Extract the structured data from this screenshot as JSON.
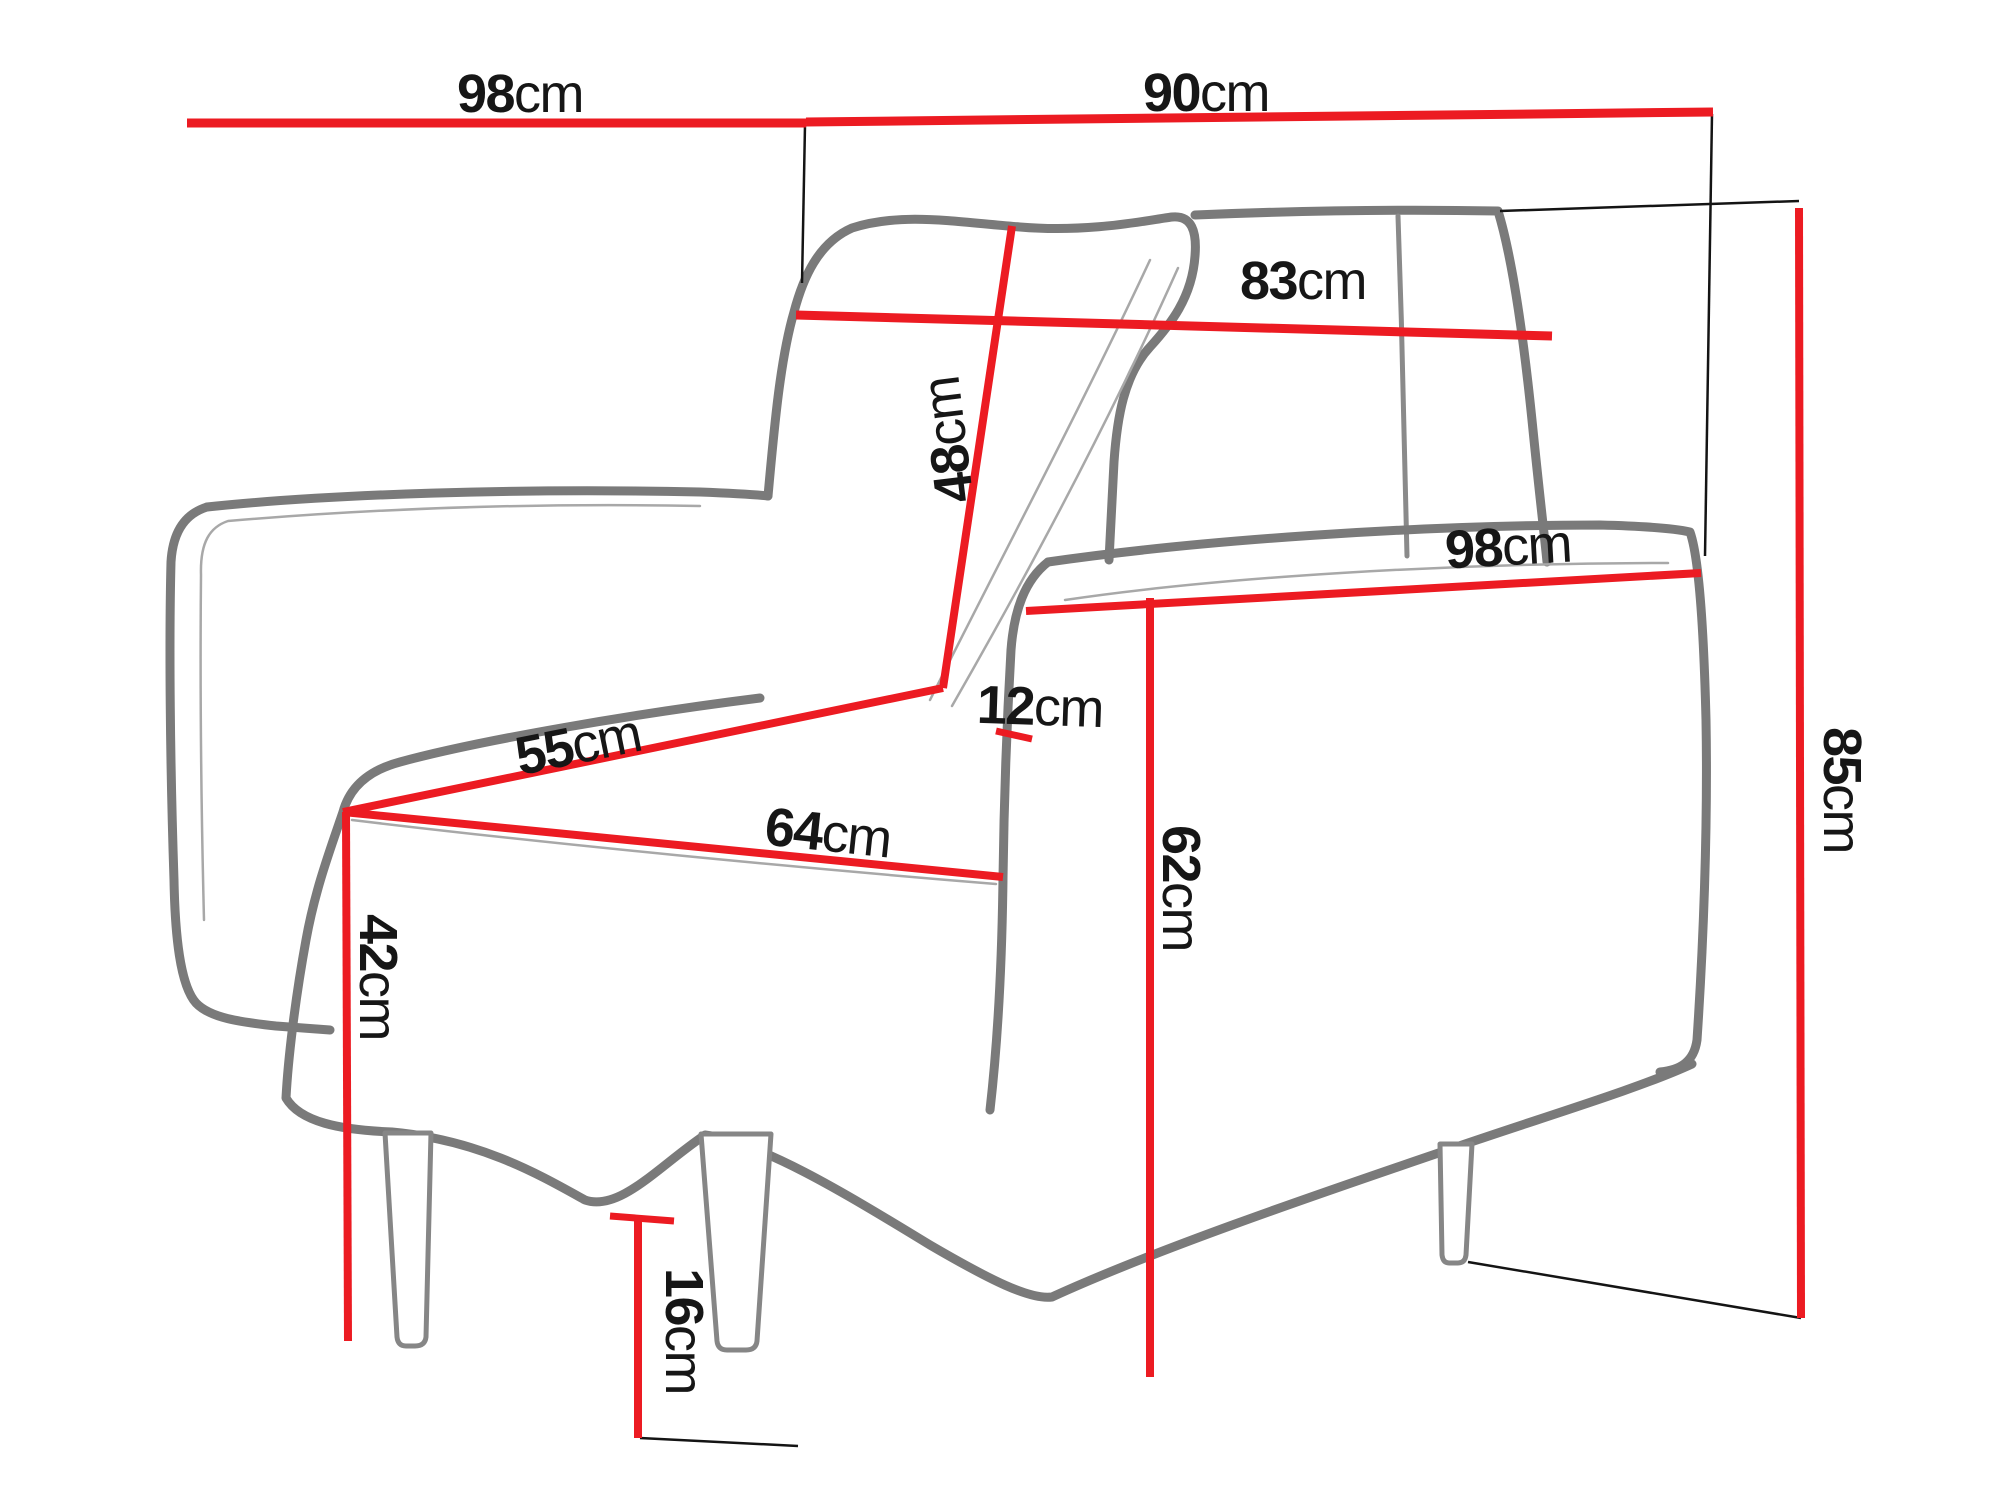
{
  "diagram": {
    "type": "furniture-dimension-diagram",
    "subject": "armchair line drawing with red dimension lines",
    "unit": "cm",
    "colors": {
      "dimension_line": "#ec1b22",
      "outline": "#7a7a7a",
      "extension_line": "#141414",
      "text": "#161616",
      "background": "#ffffff"
    },
    "labels": [
      {
        "id": "back-width-top",
        "value": "98",
        "unit": "cm"
      },
      {
        "id": "top-width-right",
        "value": "90",
        "unit": "cm"
      },
      {
        "id": "backrest-width",
        "value": "83",
        "unit": "cm"
      },
      {
        "id": "backrest-height",
        "value": "48",
        "unit": "cm"
      },
      {
        "id": "seat-depth-side",
        "value": "55",
        "unit": "cm"
      },
      {
        "id": "armrest-thickness",
        "value": "12",
        "unit": "cm"
      },
      {
        "id": "seat-width-front",
        "value": "64",
        "unit": "cm"
      },
      {
        "id": "side-length",
        "value": "98",
        "unit": "cm"
      },
      {
        "id": "armrest-height",
        "value": "62",
        "unit": "cm"
      },
      {
        "id": "overall-height",
        "value": "85",
        "unit": "cm"
      },
      {
        "id": "seat-height",
        "value": "42",
        "unit": "cm"
      },
      {
        "id": "leg-height",
        "value": "16",
        "unit": "cm"
      }
    ]
  }
}
